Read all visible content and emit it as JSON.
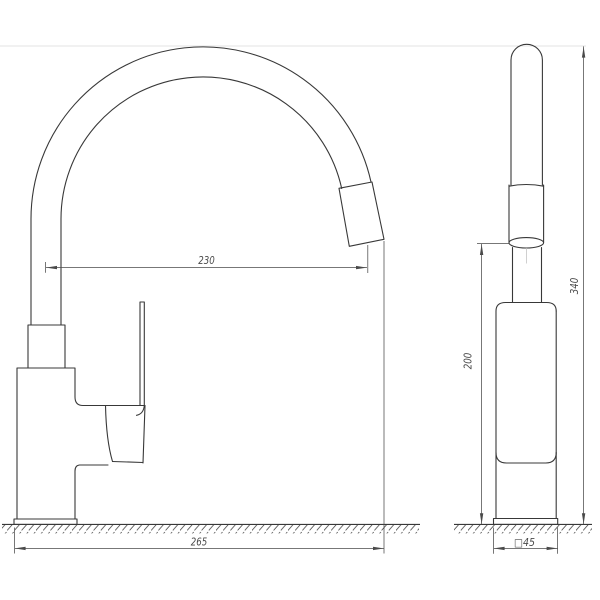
{
  "drawing": {
    "dimensions": {
      "spout_reach": "230",
      "overall_depth": "265",
      "outlet_height": "200",
      "overall_height": "340",
      "base_section": "□45"
    },
    "colors": {
      "background": "#ffffff",
      "outline": "#383838",
      "dimension": "#4a4a4a",
      "construction": "#e3e3e3"
    }
  }
}
